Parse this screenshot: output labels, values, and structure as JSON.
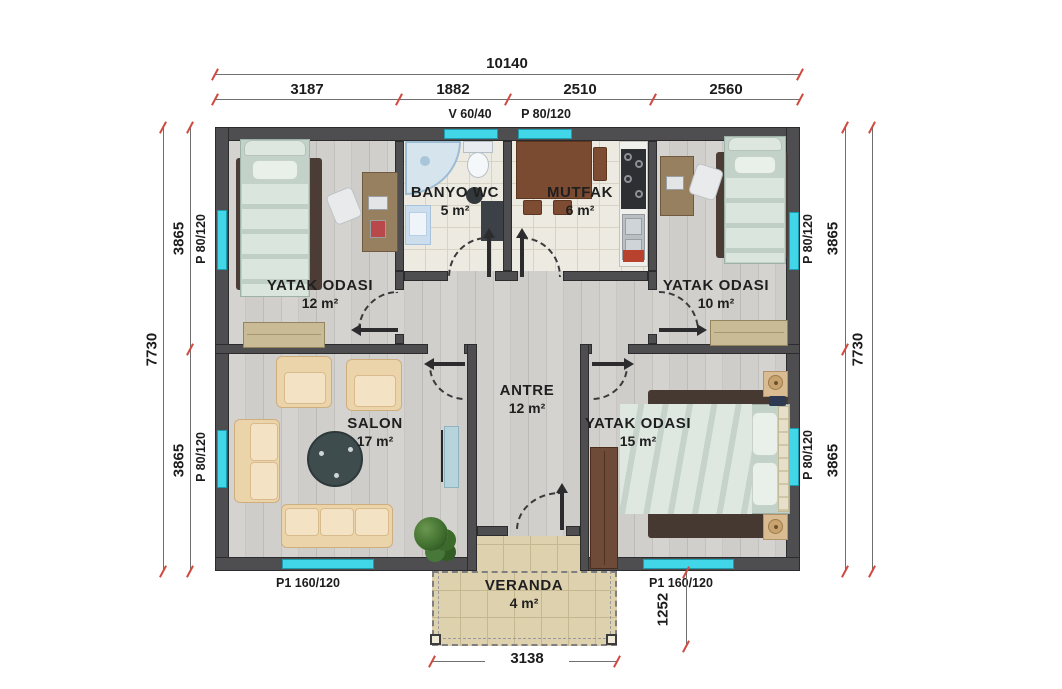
{
  "rooms": {
    "bedroom1": {
      "name": "YATAK ODASI",
      "area": "12 m²"
    },
    "bathroom": {
      "name": "BANYO WC",
      "area": "5 m²"
    },
    "kitchen": {
      "name": "MUTFAK",
      "area": "6 m²"
    },
    "bedroom2": {
      "name": "YATAK ODASI",
      "area": "10 m²"
    },
    "salon": {
      "name": "SALON",
      "area": "17 m²"
    },
    "hall": {
      "name": "ANTRE",
      "area": "12 m²"
    },
    "bedroom3": {
      "name": "YATAK ODASI",
      "area": "15 m²"
    },
    "veranda": {
      "name": "VERANDA",
      "area": "4 m²"
    }
  },
  "dimensions": {
    "top": {
      "total": "10140",
      "segments": [
        "3187",
        "1882",
        "2510",
        "2560"
      ]
    },
    "left": {
      "total": "7730",
      "segments": [
        "3865",
        "3865"
      ]
    },
    "right": {
      "total": "7730",
      "segments": [
        "3865",
        "3865"
      ]
    },
    "bottom": {
      "veranda_width": "3138",
      "veranda_depth": "1252"
    }
  },
  "openings": {
    "bath_window": "V 60/40",
    "kitchen_window": "P 80/120",
    "left_top_window": "P 80/120",
    "left_bottom_window": "P 80/120",
    "right_top_window": "P 80/120",
    "right_bottom_window": "P 80/120",
    "bottom_left_window": "P1 160/120",
    "bottom_right_window": "P1 160/120"
  },
  "colors": {
    "window": "#41d6e8",
    "wall": "#4e4e50",
    "dimension_tick": "#cf4a3f",
    "veranda_floor": "#ddd1ae",
    "wood_floor": "#c9c8c5",
    "tile_floor": "#edeae1"
  }
}
